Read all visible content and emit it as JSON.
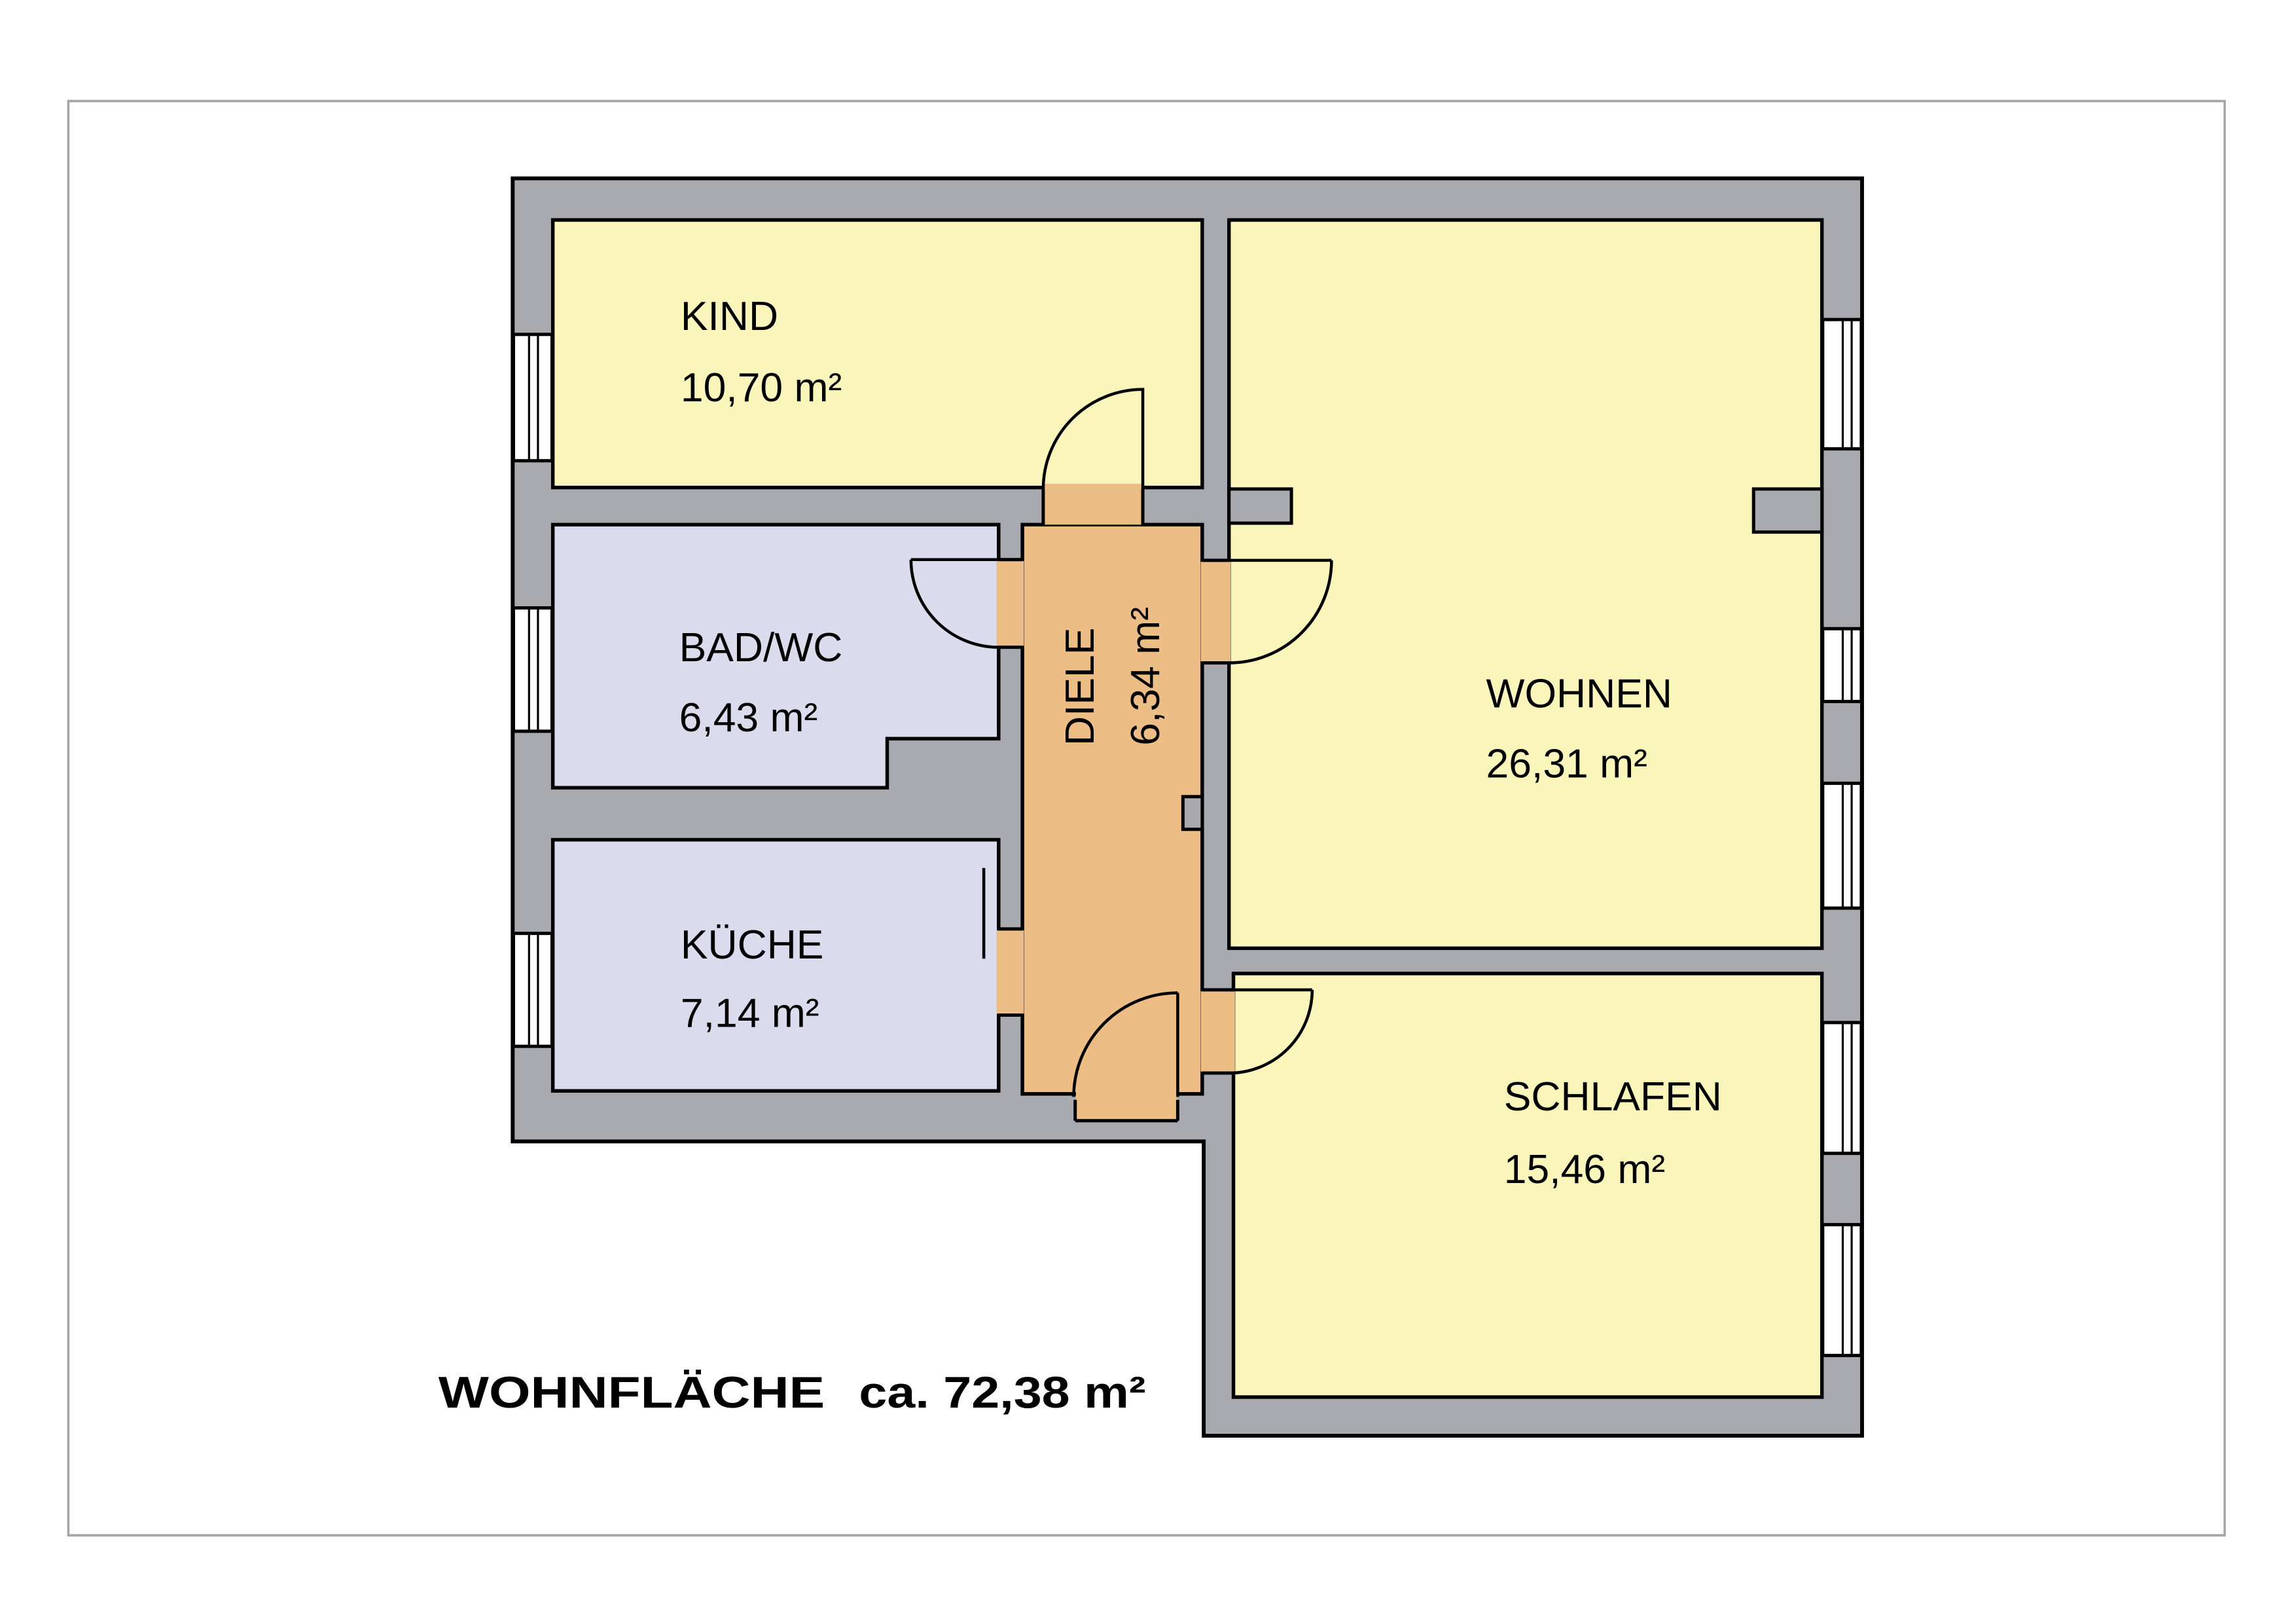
{
  "plan": {
    "rooms": [
      {
        "id": "kind",
        "name": "KIND",
        "area": "10,70 m²",
        "floor_color": "#FAF5BB"
      },
      {
        "id": "bad_wc",
        "name": "BAD/WC",
        "area": "6,43 m²",
        "floor_color": "#DADBEC"
      },
      {
        "id": "kueche",
        "name": "KÜCHE",
        "area": "7,14 m²",
        "floor_color": "#DADBEC"
      },
      {
        "id": "diele",
        "name": "DIELE",
        "area": "6,34 m²",
        "floor_color": "#ECBE85"
      },
      {
        "id": "wohnen",
        "name": "WOHNEN",
        "area": "26,31 m²",
        "floor_color": "#FAF5BB"
      },
      {
        "id": "schlafen",
        "name": "SCHLAFEN",
        "area": "15,46 m²",
        "floor_color": "#FAF5BB"
      }
    ],
    "summary": {
      "label": "WOHNFLÄCHE",
      "value": "ca. 72,38 m²"
    },
    "features": {
      "doors": [
        "kind",
        "bad_wc",
        "kueche",
        "wohnen",
        "schlafen",
        "entry"
      ],
      "windows_left_wall": 3,
      "windows_right_wall": 5
    },
    "colors": {
      "wall": "#A9A9B0",
      "outline": "#000000",
      "window_fill": "#FFFFFF",
      "frame_border": "#A6A6A6",
      "background": "#FFFFFF"
    }
  }
}
